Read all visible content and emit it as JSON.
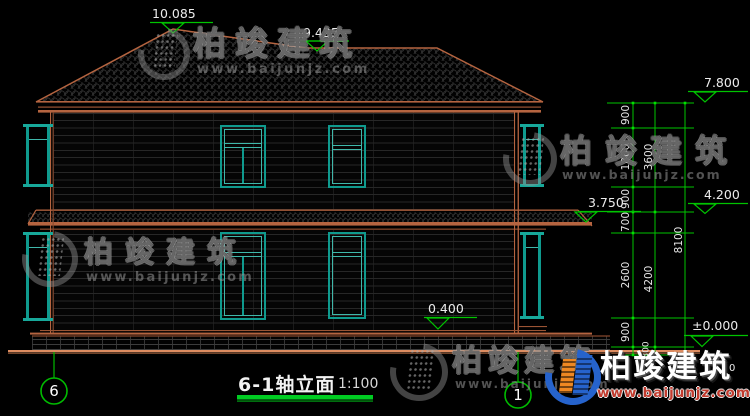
{
  "drawing_title": {
    "name": "6-1轴立面",
    "scale": "1:100"
  },
  "axis_markers": {
    "left": "6",
    "right": "1"
  },
  "elevation_labels": {
    "roof_peak": "10.085",
    "roof_ridge": "9.435",
    "eave": "7.800",
    "second_floor": "4.200",
    "canopy": "3.750",
    "plinth": "0.400",
    "ground": "±0.000",
    "partial_digit": "0"
  },
  "dimensions": {
    "inner_chain": [
      "900",
      "1800",
      "900",
      "700",
      "2600",
      "900",
      "300"
    ],
    "middle_chain": [
      "3600",
      "4200"
    ],
    "overall_chain": [
      "8100"
    ]
  },
  "watermark": {
    "brand": "柏竣建筑",
    "url": "www.baijunjz.com"
  },
  "colors": {
    "window_teal": "#0f9a8e",
    "outline_sienna": "#b56440",
    "dimension_green": "#00c400",
    "ground_orange": "#dd8c60",
    "logo_blue": "#2663cc",
    "logo_orange": "#ee8822"
  }
}
